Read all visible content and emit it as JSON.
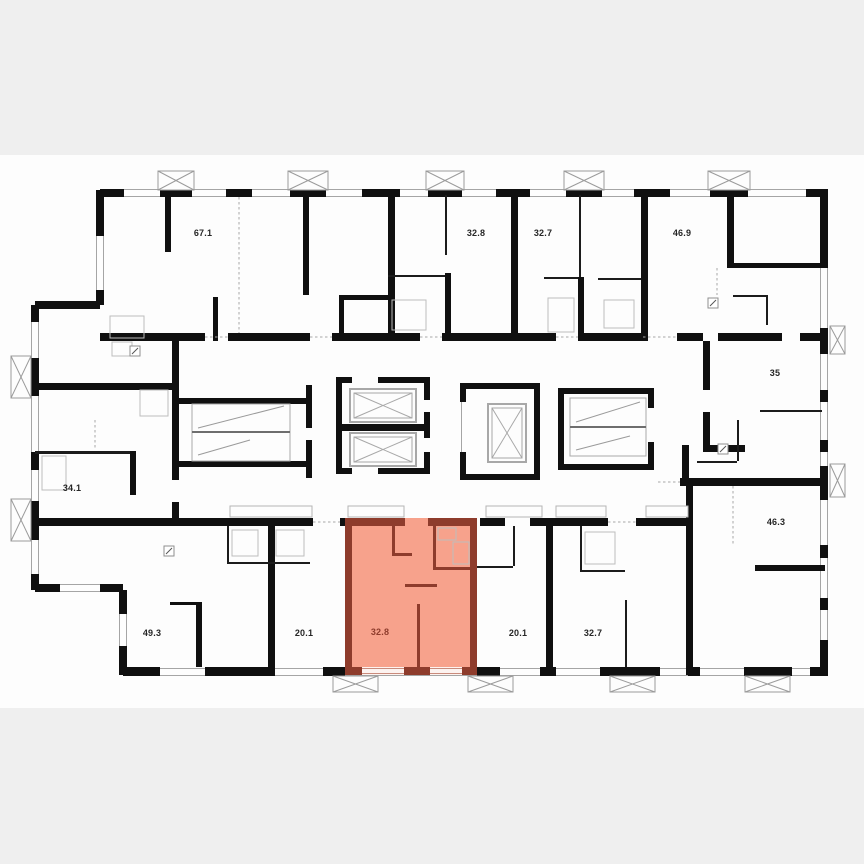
{
  "plan": {
    "type": "residential-floor-plan",
    "units": [
      {
        "id": "unit-top-1",
        "area": "67.1",
        "highlighted": false
      },
      {
        "id": "unit-top-2",
        "area": "32.8",
        "highlighted": false
      },
      {
        "id": "unit-top-3",
        "area": "32.7",
        "highlighted": false
      },
      {
        "id": "unit-top-4",
        "area": "46.9",
        "highlighted": false
      },
      {
        "id": "unit-right-1",
        "area": "35",
        "highlighted": false
      },
      {
        "id": "unit-left-1",
        "area": "34.1",
        "highlighted": false
      },
      {
        "id": "unit-right-2",
        "area": "46.3",
        "highlighted": false
      },
      {
        "id": "unit-bottom-1",
        "area": "49.3",
        "highlighted": false
      },
      {
        "id": "unit-bottom-2",
        "area": "20.1",
        "highlighted": false
      },
      {
        "id": "unit-bottom-3",
        "area": "32.8",
        "highlighted": true
      },
      {
        "id": "unit-bottom-4",
        "area": "20.1",
        "highlighted": false
      },
      {
        "id": "unit-bottom-5",
        "area": "32.7",
        "highlighted": false
      }
    ],
    "highlight": {
      "fill": "#f7a28c",
      "wall": "#8e3c2c"
    },
    "colors": {
      "canvas": "#efefef",
      "paper": "#fdfdfd",
      "wall": "#101010"
    }
  }
}
